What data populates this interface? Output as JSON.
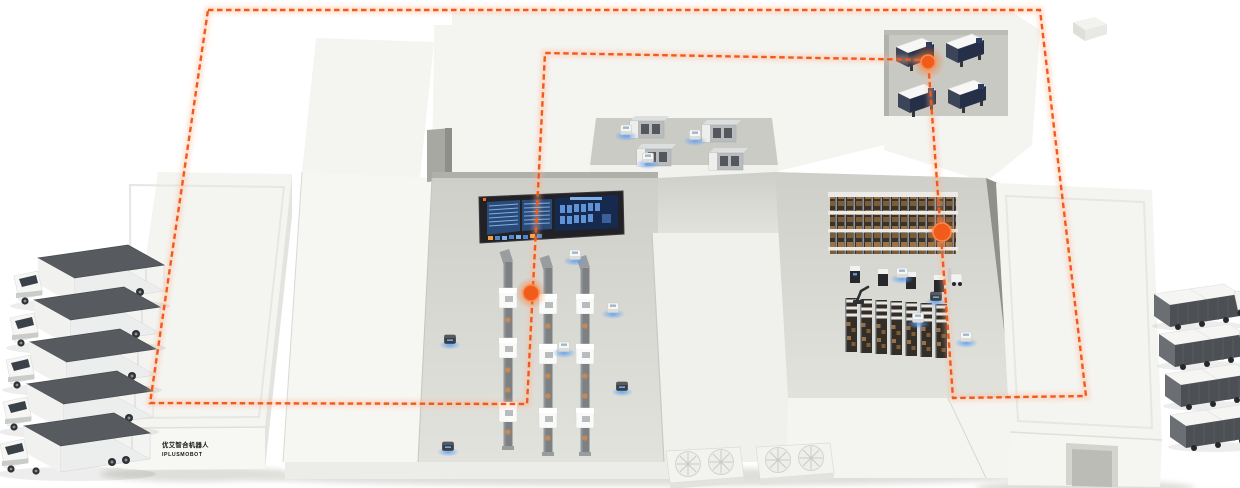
{
  "logo": {
    "line1": "优艾智合机器人",
    "line2": "IPLUSMOBOT",
    "icon_color": "#f4701f",
    "text_color": "#161616"
  },
  "route": {
    "color": "#f2591c",
    "halo_color": "#ffb38a",
    "dash_pattern": "5.5 3.5",
    "loop_points": "208,10 1040,10 1086,396 953,398 928,60 545,53 527,404 150,403",
    "waypoints": [
      {
        "x": 928,
        "y": 62
      },
      {
        "x": 942,
        "y": 232
      },
      {
        "x": 531,
        "y": 293
      }
    ]
  },
  "fleet": {
    "trucks_inbound_left": 5,
    "trucks_outbound_right": 4,
    "agvs_on_floor": 13
  },
  "facility": {
    "conveyor_lines": 3,
    "machines_per_line": 3,
    "machining_center_machines": 4,
    "inspection_cell_machines": 4,
    "rack_columns": 7,
    "fan_units": 2,
    "dashboard_screens": 3
  },
  "dashboard": {
    "frame_color": "#222226",
    "screen_color": "#2a4a78",
    "screen_dark_color": "#16294e",
    "row_color": "#7fb0e8",
    "chip_orange": "#f4a13c"
  },
  "palette": {
    "background": "#ffffff",
    "roof_white": "#f4f4f1",
    "wall_white": "#e9e9e6",
    "floor_gray": "#d8d8d3",
    "container_dark": "#565a5e",
    "rack_dark": "#38322b",
    "box_tan": "#9c7345",
    "agv_glow_blue": "#5fa0f0"
  }
}
